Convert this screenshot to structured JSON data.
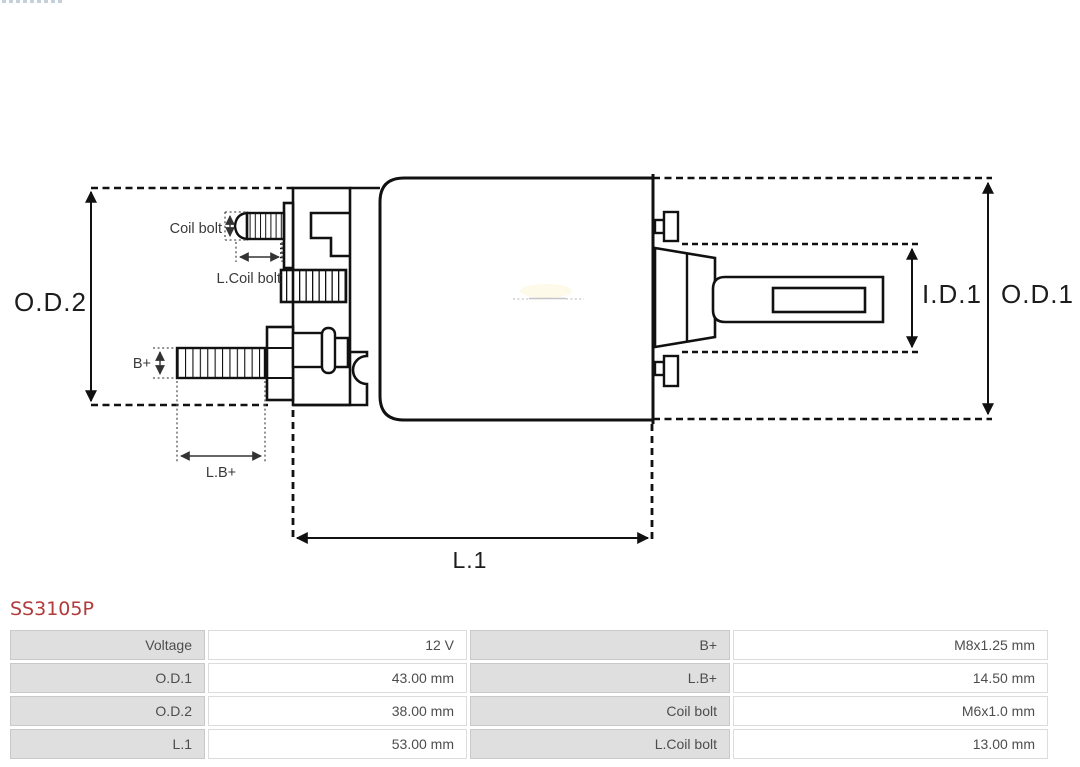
{
  "title": {
    "part_number": "SS3105P"
  },
  "diagram": {
    "labels": {
      "od2": "O.D.2",
      "od1": "O.D.1",
      "id1": "I.D.1",
      "l1": "L.1",
      "coil_bolt": "Coil bolt",
      "l_coil_bolt": "L.Coil bolt",
      "b_plus": "B+",
      "l_b_plus": "L.B+"
    }
  },
  "specs": {
    "rows": [
      {
        "label_left": "Voltage",
        "value_left": "12 V",
        "label_right": "B+",
        "value_right": "M8x1.25 mm"
      },
      {
        "label_left": "O.D.1",
        "value_left": "43.00 mm",
        "label_right": "L.B+",
        "value_right": "14.50 mm"
      },
      {
        "label_left": "O.D.2",
        "value_left": "38.00 mm",
        "label_right": "Coil bolt",
        "value_right": "M6x1.0 mm"
      },
      {
        "label_left": "L.1",
        "value_left": "53.00 mm",
        "label_right": "L.Coil bolt",
        "value_right": "13.00 mm"
      }
    ]
  },
  "colors": {
    "part_number_red": "#b23a3a",
    "label_cell_bg": "#dfdfdf",
    "value_cell_bg": "#ffffff",
    "drawing_line": "#111111",
    "annotation_gray": "#3a3a3a"
  }
}
